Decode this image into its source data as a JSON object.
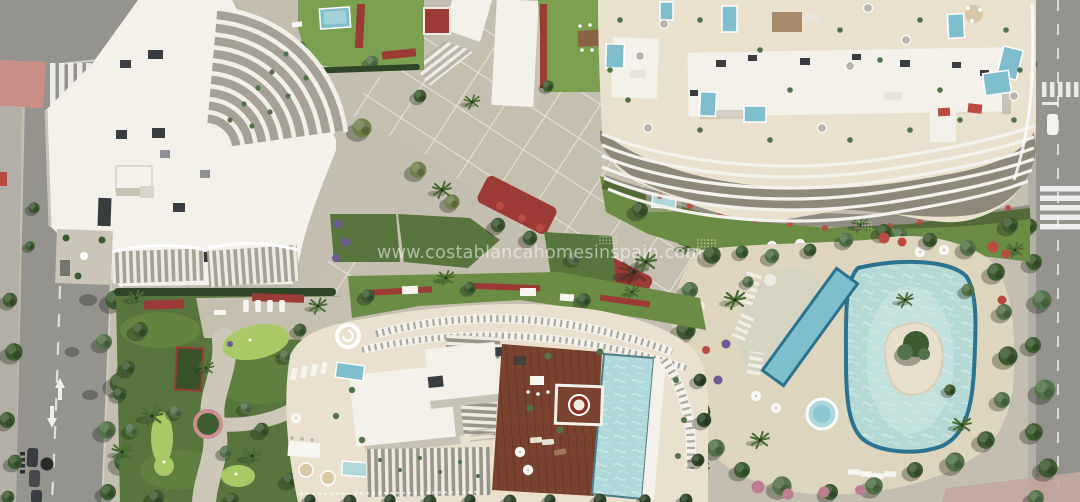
{
  "watermark": {
    "text": "www.costablancahomesinspain.com"
  },
  "scene": {
    "description": "Aerial top-down 3D render of a Costa Blanca residential complex: two white apartment blocks with rooftop terraces and private plunge pools, a third building with a rooftop infinity pool and wooden deck, a central diagonal paved promenade, landscaped gardens with putting greens, a large lagoon-style communal pool with a planted island, a lap pool and a round jacuzzi, bordered by city roads on the left and right."
  },
  "colors": {
    "ground": "#c4beb1",
    "road": "#95938e",
    "sidewalk": "#b2afa6",
    "red_pave": "#c98e86",
    "white": "#f3f1ea",
    "white_shadow": "#c6c2b6",
    "cream": "#e9e1cd",
    "sand": "#ded5bf",
    "paving": "#c5bfb0",
    "paveline": "#eeece4",
    "grass_bright": "#7aa050",
    "grass": "#6a8c45",
    "grass_dark": "#57753c",
    "putting": "#a9c966",
    "hedge": "#2e4527",
    "tree1": "#3d5a30",
    "tree2": "#53724a",
    "olive": "#707f4b",
    "pool_light": "#aed8da",
    "pool_mid": "#7fbecd",
    "pool_rim": "#2c7390",
    "lagoon": "#b4d9d5",
    "island": "#e7decb",
    "flower_red": "#9c3a35",
    "flower_red2": "#bb4a40",
    "flower_pink": "#bf7d92",
    "flower_purple": "#6f5a94",
    "wood": "#794330",
    "wood_line": "#5b2f22",
    "dark": "#3a3d40",
    "facade_shadow": "#8e887a"
  }
}
